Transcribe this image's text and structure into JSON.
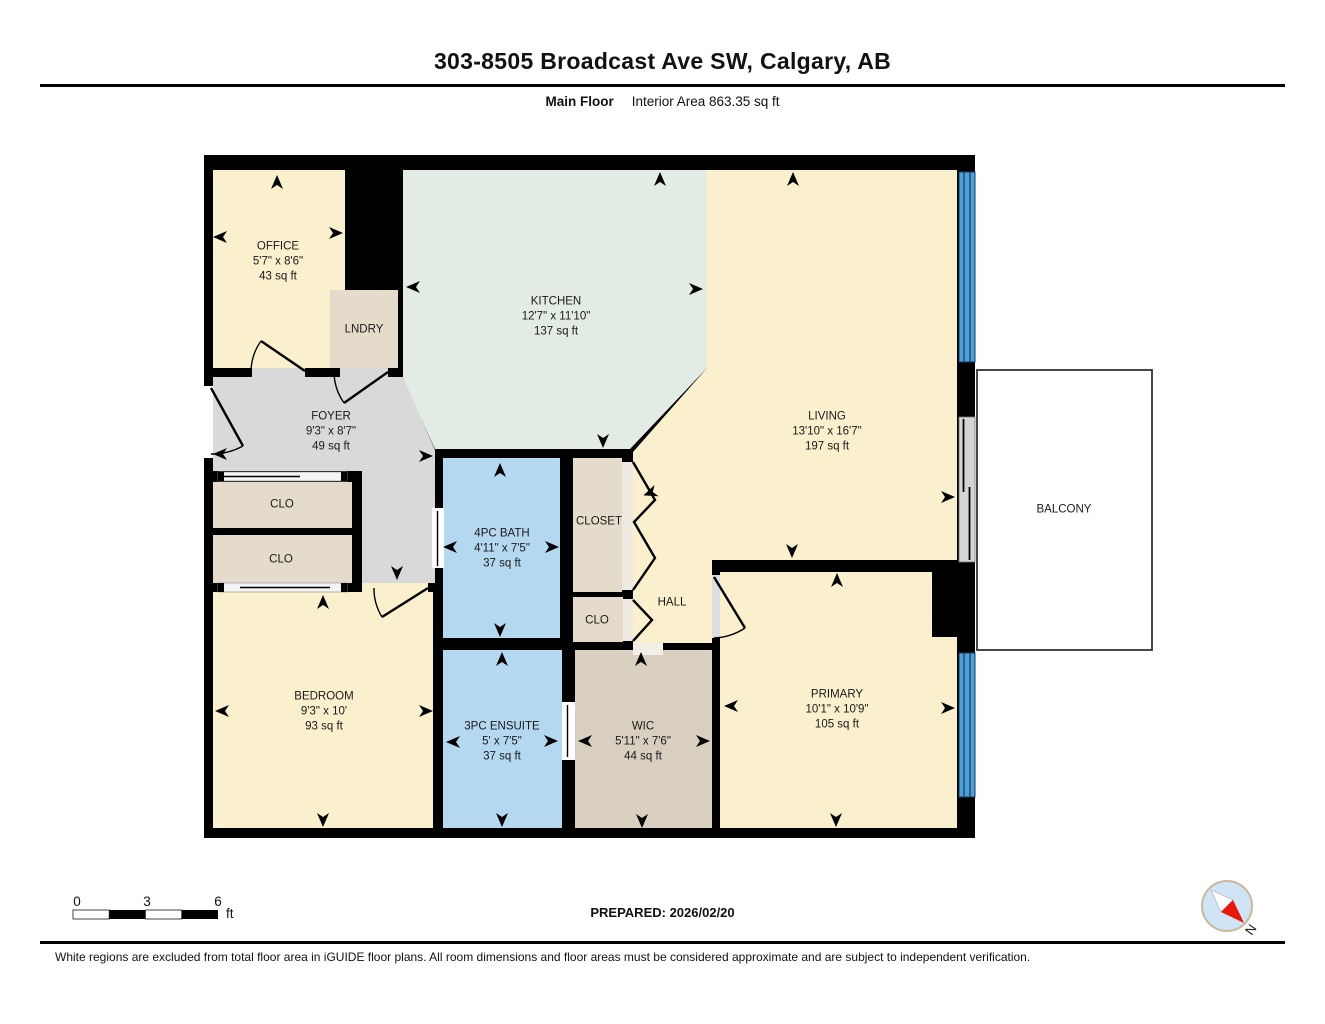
{
  "header": {
    "title": "303-8505 Broadcast Ave SW, Calgary, AB",
    "floor_label": "Main Floor",
    "area_label": "Interior Area 863.35 sq ft"
  },
  "rooms": {
    "office": {
      "name": "OFFICE",
      "dims": "5'7\" x 8'6\"",
      "area": "43 sq ft"
    },
    "lndry": {
      "name": "LNDRY"
    },
    "kitchen": {
      "name": "KITCHEN",
      "dims": "12'7\" x 11'10\"",
      "area": "137 sq ft"
    },
    "living": {
      "name": "LIVING",
      "dims": "13'10\" x 16'7\"",
      "area": "197 sq ft"
    },
    "foyer": {
      "name": "FOYER",
      "dims": "9'3\" x 8'7\"",
      "area": "49 sq ft"
    },
    "clo1": {
      "name": "CLO"
    },
    "clo2": {
      "name": "CLO"
    },
    "bath": {
      "name": "4PC BATH",
      "dims": "4'11\" x 7'5\"",
      "area": "37 sq ft"
    },
    "closet": {
      "name": "CLOSET"
    },
    "clo3": {
      "name": "CLO"
    },
    "hall": {
      "name": "HALL"
    },
    "bedroom": {
      "name": "BEDROOM",
      "dims": "9'3\" x 10'",
      "area": "93 sq ft"
    },
    "ensuite": {
      "name": "3PC ENSUITE",
      "dims": "5' x 7'5\"",
      "area": "37 sq ft"
    },
    "wic": {
      "name": "WIC",
      "dims": "5'11\" x 7'6\"",
      "area": "44 sq ft"
    },
    "primary": {
      "name": "PRIMARY",
      "dims": "10'1\" x 10'9\"",
      "area": "105 sq ft"
    },
    "balcony": {
      "name": "BALCONY"
    }
  },
  "scale_bar": {
    "tick0": "0",
    "tick1": "3",
    "tick2": "6",
    "unit": "ft"
  },
  "footer": {
    "prepared": "PREPARED: 2026/02/20",
    "disclaimer": "White regions are excluded from total floor area in iGUIDE floor plans. All room dimensions and floor areas must be considered approximate and are subject to independent verification.",
    "compass_label": "N"
  },
  "colors": {
    "cream_room": "#FAF0CE",
    "kitchen_mint": "#E3ECE4",
    "foyer_gray": "#D9D9D9",
    "closet_beige": "#E5DBCB",
    "wic_taupe": "#D8CFC0",
    "bath_blue": "#B5D8F1",
    "window_blue": "#4E9FD8",
    "wall_black": "#000000",
    "compass_red": "#E8190C",
    "compass_blue": "#CFE4F5"
  }
}
